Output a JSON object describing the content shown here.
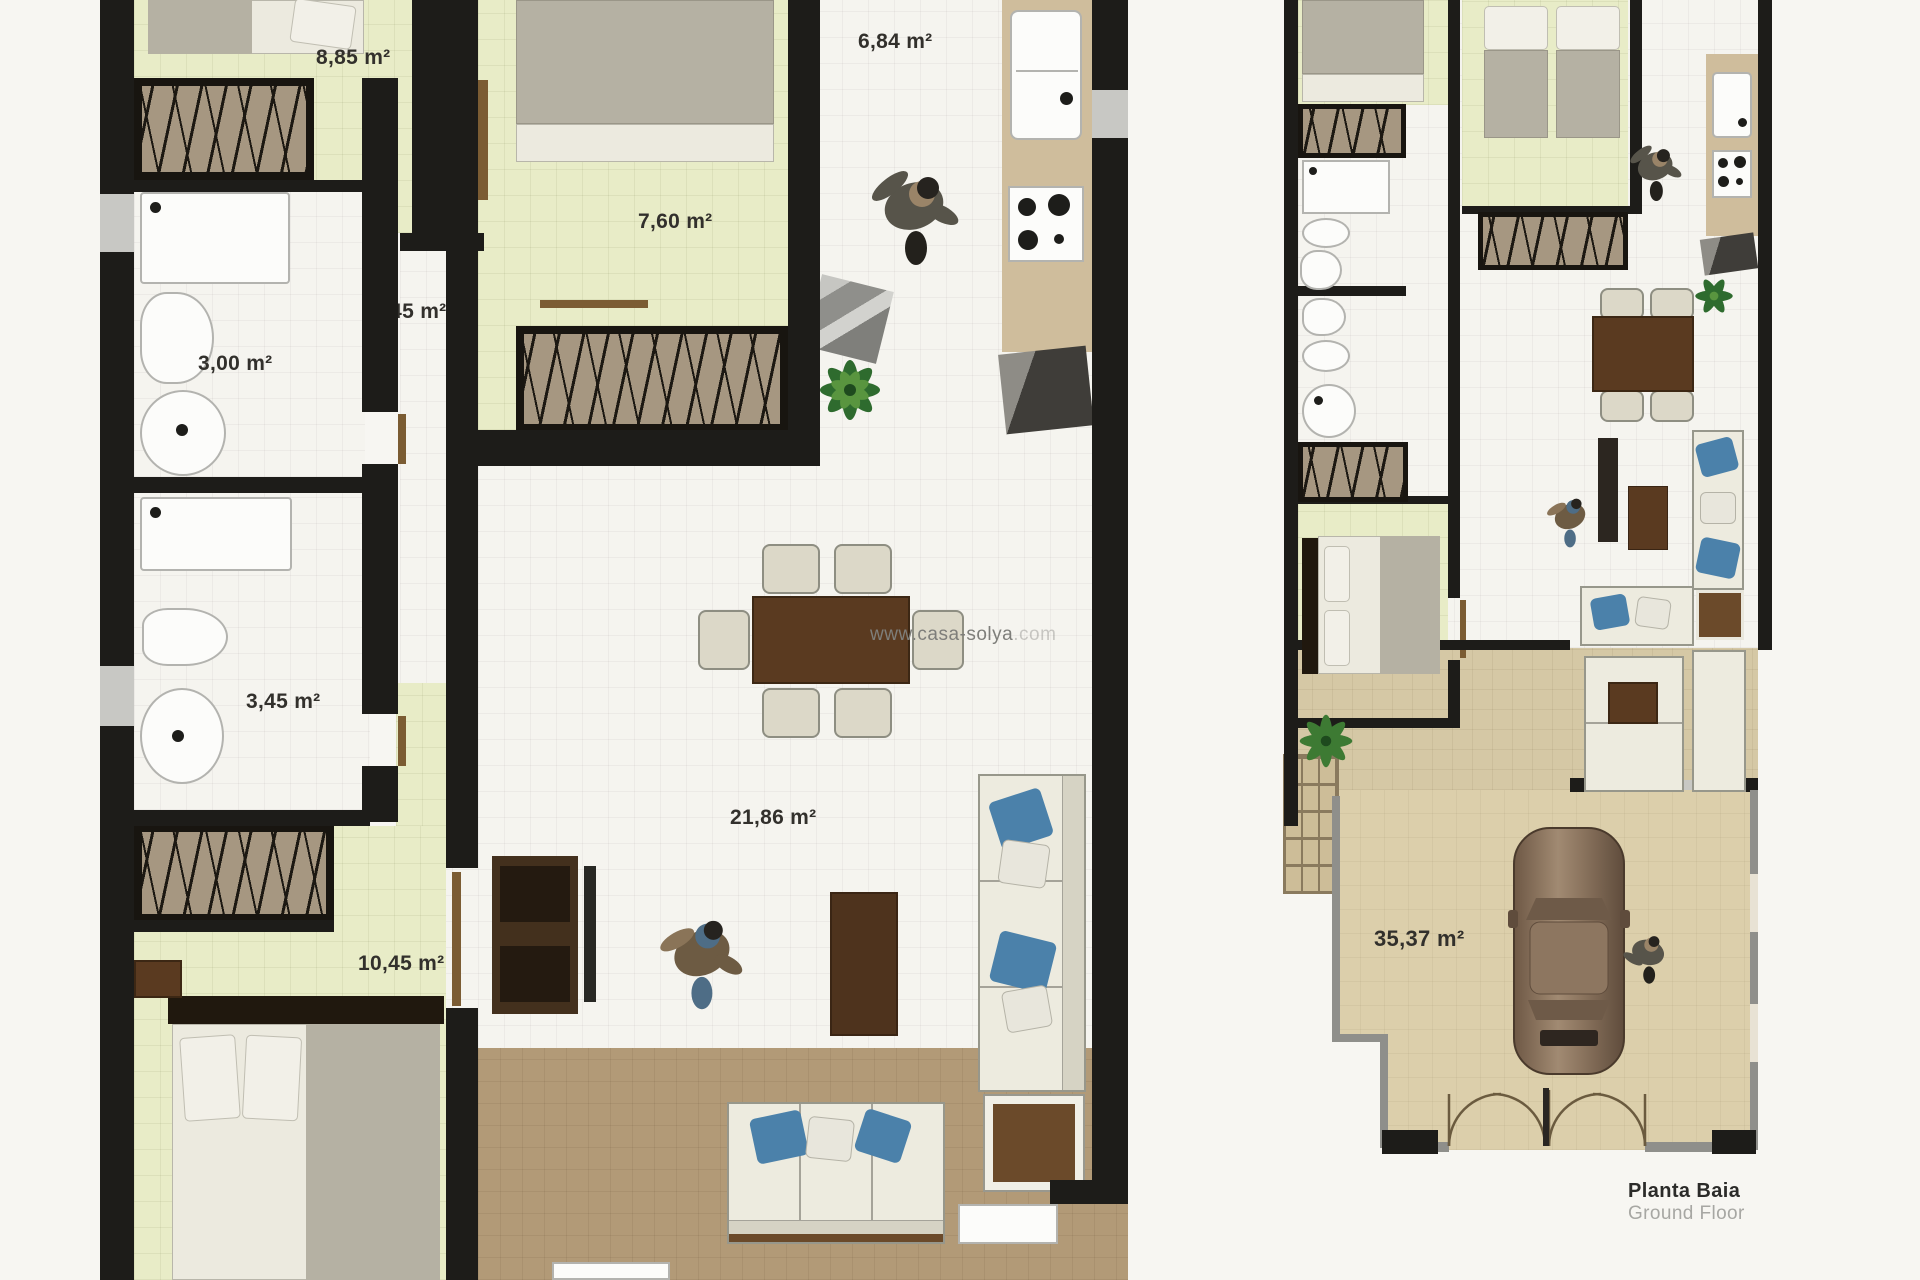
{
  "watermark": {
    "visible": "www.casa-solya",
    "faint": ".com"
  },
  "left_plan": {
    "rooms": [
      {
        "room": "bedroom-top-left",
        "label": "8,85 m²"
      },
      {
        "room": "kitchen-hall",
        "label": "6,84 m²"
      },
      {
        "room": "bedroom-middle",
        "label": "7,60 m²"
      },
      {
        "room": "hallway",
        "label": "3,45 m²"
      },
      {
        "room": "bathroom-top",
        "label": "3,00 m²"
      },
      {
        "room": "bathroom-bottom",
        "label": "3,45 m²"
      },
      {
        "room": "living-dining",
        "label": "21,86 m²"
      },
      {
        "room": "bedroom-bottom",
        "label": "10,45 m²"
      }
    ]
  },
  "right_plan": {
    "rooms": [
      {
        "room": "garage-driveway",
        "label": "35,37 m²"
      }
    ],
    "caption": {
      "title": "Planta Baia",
      "subtitle": "Ground Floor"
    }
  },
  "colors": {
    "wall": "#1d1c19",
    "bedroom_floor": "#e8ecc7",
    "bath_floor": "#f5f4ef",
    "kitchen_counter": "#cfbd9c",
    "terrace_floor": "#b29a77",
    "garage_floor": "#dccfab",
    "pillow_blue": "#4b81aa",
    "furniture_brown": "#5a3a20"
  }
}
